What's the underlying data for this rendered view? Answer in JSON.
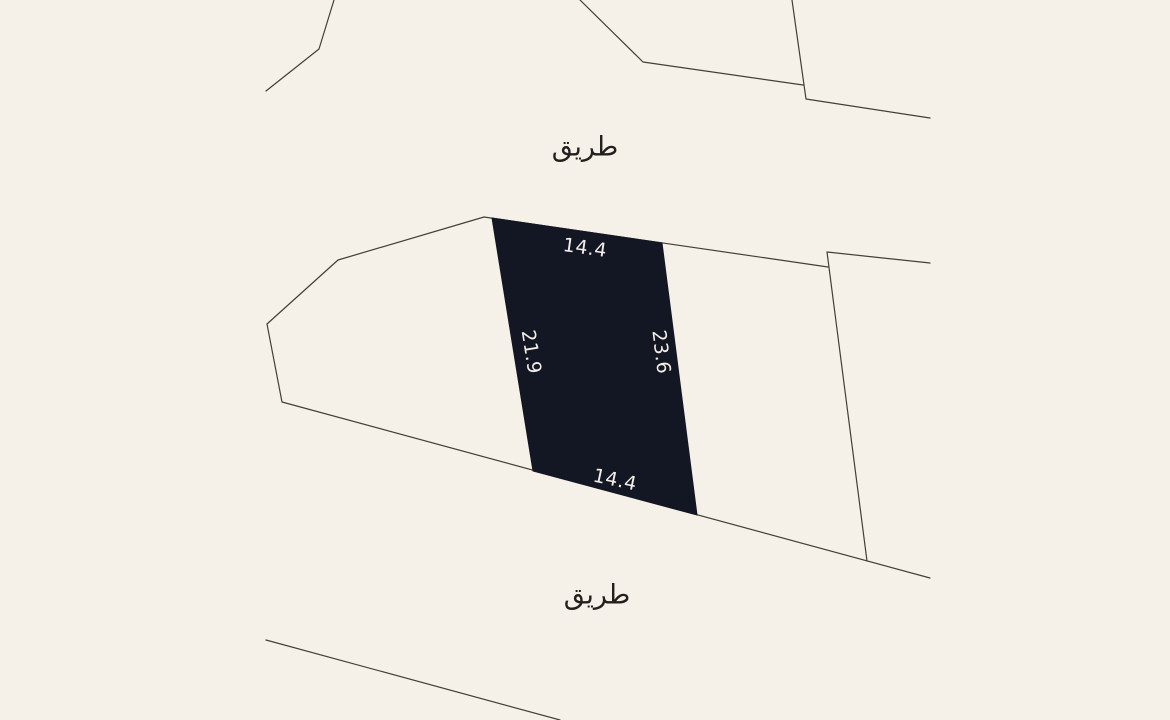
{
  "map": {
    "background_color": "#f5f1e9",
    "line_color": "#433f38",
    "line_width": 1.2,
    "road_labels": [
      {
        "name": "road-label-top",
        "text": "طريق",
        "meaning": "road",
        "x": 585,
        "y": 147
      },
      {
        "name": "road-label-bottom",
        "text": "طريق",
        "meaning": "road",
        "x": 597,
        "y": 595
      }
    ],
    "road_label_color": "#231f1c",
    "highlight_parcel": {
      "fill": "#131623",
      "points": [
        [
          492,
          218
        ],
        [
          662,
          243
        ],
        [
          697,
          515
        ],
        [
          533,
          471
        ]
      ],
      "dimension_label_color": "#f3efe8",
      "dimensions": [
        {
          "side": "top",
          "text": "14.4",
          "x": 585,
          "y": 248,
          "rotation": 8
        },
        {
          "side": "right",
          "text": "23.6",
          "x": 661,
          "y": 352,
          "rotation": 83
        },
        {
          "side": "bottom",
          "text": "14.4",
          "x": 615,
          "y": 480,
          "rotation": 12
        },
        {
          "side": "left",
          "text": "21.9",
          "x": 531,
          "y": 352,
          "rotation": 81
        }
      ]
    },
    "boundary_lines": [
      {
        "name": "boundary-upper-left",
        "points": [
          [
            334,
            0
          ],
          [
            319,
            49
          ],
          [
            266,
            91
          ]
        ]
      },
      {
        "name": "boundary-upper-middle",
        "points": [
          [
            580,
            0
          ],
          [
            643,
            62
          ],
          [
            803,
            85
          ]
        ]
      },
      {
        "name": "boundary-upper-right",
        "points": [
          [
            792,
            0
          ],
          [
            806,
            99
          ],
          [
            930,
            118
          ]
        ]
      },
      {
        "name": "block-top-edge",
        "points": [
          [
            267,
            324
          ],
          [
            338,
            260
          ],
          [
            484,
            217
          ],
          [
            828,
            267
          ]
        ]
      },
      {
        "name": "block-bottom-edge",
        "points": [
          [
            267,
            324
          ],
          [
            282,
            402
          ],
          [
            930,
            578
          ]
        ]
      },
      {
        "name": "right-parcel-right-edge",
        "points": [
          [
            827,
            252
          ],
          [
            867,
            561
          ]
        ]
      },
      {
        "name": "right-block-top-edge",
        "points": [
          [
            827,
            252
          ],
          [
            930,
            263
          ]
        ]
      },
      {
        "name": "boundary-lower-left",
        "points": [
          [
            266,
            640
          ],
          [
            560,
            720
          ]
        ]
      }
    ]
  }
}
